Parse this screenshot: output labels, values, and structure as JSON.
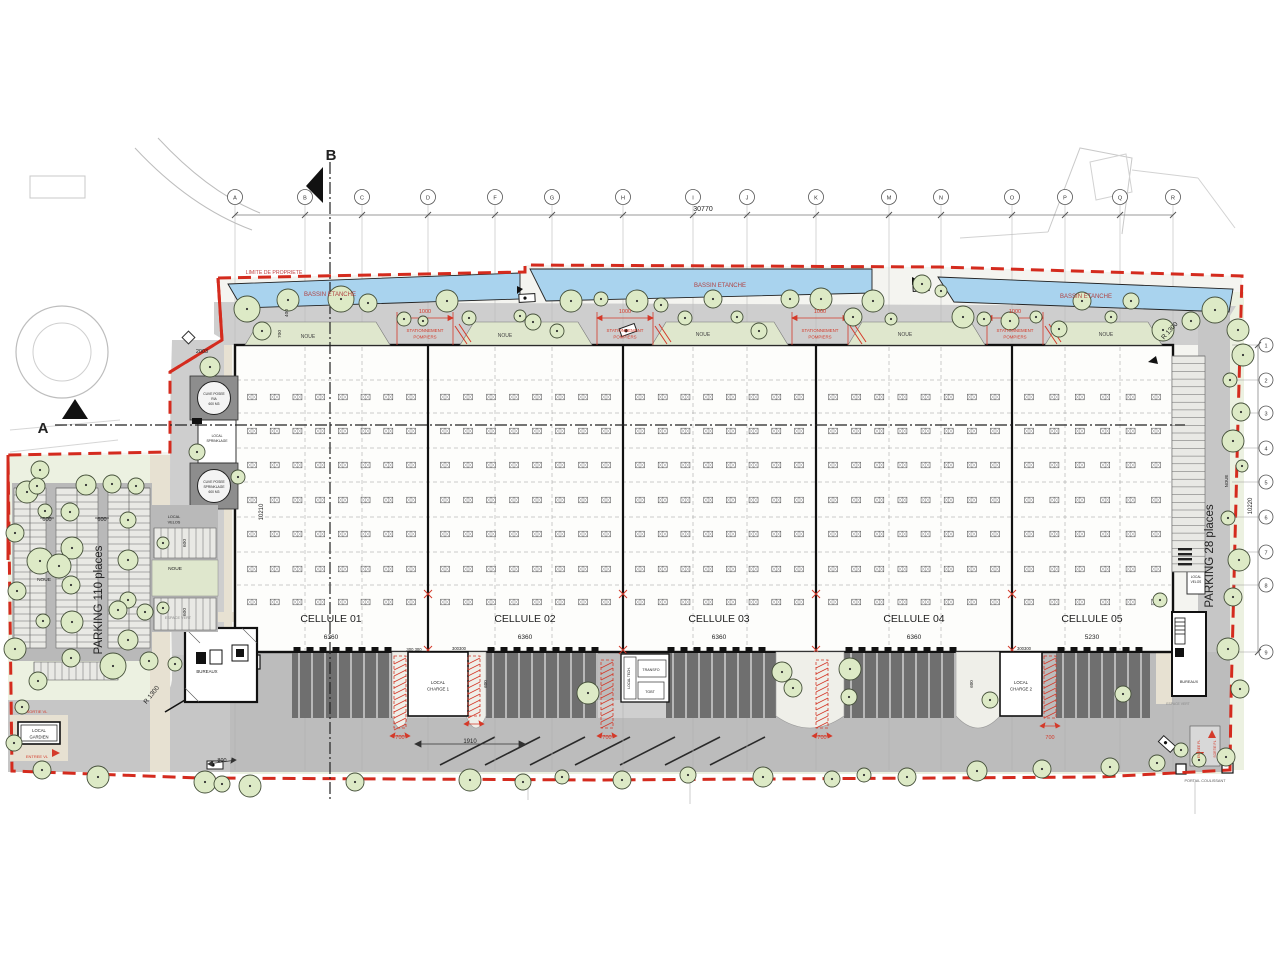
{
  "drawing": {
    "kind": "architectural site plan - logistics warehouse",
    "boundary_color": "#d42b1e",
    "water_color": "#a9d3ee",
    "tree_fill": "#ddeac6"
  },
  "grid": {
    "letters": [
      "A",
      "B",
      "C",
      "D",
      "F",
      "G",
      "H",
      "I",
      "J",
      "K",
      "M",
      "N",
      "O",
      "P",
      "Q",
      "R"
    ],
    "rows": [
      "1",
      "2",
      "3",
      "4",
      "5",
      "6",
      "7",
      "8",
      "9"
    ],
    "overall_dim": "30770",
    "right_dim": "10220"
  },
  "cellules": [
    {
      "label": "CELLULE 01",
      "dim": "6360"
    },
    {
      "label": "CELLULE 02",
      "dim": "6360"
    },
    {
      "label": "CELLULE 03",
      "dim": "6360"
    },
    {
      "label": "CELLULE 04",
      "dim": "6360"
    },
    {
      "label": "CELLULE 05",
      "dim": "5230"
    }
  ],
  "annotations": [
    {
      "name": "section-label-b",
      "text": "B",
      "x": 331,
      "y": 160,
      "size": 15,
      "bold": true
    },
    {
      "name": "section-label-a",
      "text": "A",
      "x": 43,
      "y": 433,
      "size": 15,
      "bold": true
    },
    {
      "name": "limite-propriete-label",
      "text": "LIMITE DE PROPRIETE",
      "x": 274,
      "y": 274,
      "size": 5.2,
      "color": "#c04040"
    },
    {
      "name": "bassin-etanche-label-1",
      "text": "BASSIN ETANCHE",
      "x": 330,
      "y": 296,
      "size": 6,
      "color": "#b04040"
    },
    {
      "name": "bassin-etanche-label-2",
      "text": "BASSIN ETANCHE",
      "x": 720,
      "y": 287,
      "size": 6,
      "color": "#b04040"
    },
    {
      "name": "bassin-etanche-label-3",
      "text": "BASSIN ETANCHE",
      "x": 1086,
      "y": 298,
      "size": 6,
      "color": "#b04040"
    },
    {
      "name": "overall-dim-label",
      "text": "30770",
      "x": 703,
      "y": 211,
      "size": 7,
      "color": "#222"
    },
    {
      "name": "noue-label-1",
      "text": "NOUE",
      "x": 308,
      "y": 338,
      "size": 5,
      "color": "#444"
    },
    {
      "name": "noue-label-2",
      "text": "NOUE",
      "x": 505,
      "y": 337,
      "size": 5,
      "color": "#444"
    },
    {
      "name": "noue-label-3",
      "text": "NOUE",
      "x": 703,
      "y": 336,
      "size": 5,
      "color": "#444"
    },
    {
      "name": "noue-label-4",
      "text": "NOUE",
      "x": 905,
      "y": 336,
      "size": 5,
      "color": "#444"
    },
    {
      "name": "noue-label-5",
      "text": "NOUE",
      "x": 1106,
      "y": 336,
      "size": 5,
      "color": "#444"
    },
    {
      "name": "pompiers-dim-1",
      "text": "1000",
      "x": 425,
      "y": 313,
      "size": 5.5,
      "color": "#d43a2a"
    },
    {
      "name": "pompiers-label-1a",
      "text": "STATIONNEMENT",
      "x": 425,
      "y": 332,
      "size": 4.4,
      "color": "#d43a2a"
    },
    {
      "name": "pompiers-label-1b",
      "text": "POMPIERS",
      "x": 425,
      "y": 338.5,
      "size": 4.4,
      "color": "#d43a2a"
    },
    {
      "name": "pompiers-dim-2",
      "text": "1000",
      "x": 625,
      "y": 313,
      "size": 5.5,
      "color": "#d43a2a"
    },
    {
      "name": "pompiers-label-2a",
      "text": "STATIONNEMENT",
      "x": 625,
      "y": 332,
      "size": 4.4,
      "color": "#d43a2a"
    },
    {
      "name": "pompiers-label-2b",
      "text": "POMPIERS",
      "x": 625,
      "y": 338.5,
      "size": 4.4,
      "color": "#d43a2a"
    },
    {
      "name": "pompiers-dim-3",
      "text": "1000",
      "x": 820,
      "y": 313,
      "size": 5.5,
      "color": "#d43a2a"
    },
    {
      "name": "pompiers-label-3a",
      "text": "STATIONNEMENT",
      "x": 820,
      "y": 332,
      "size": 4.4,
      "color": "#d43a2a"
    },
    {
      "name": "pompiers-label-3b",
      "text": "POMPIERS",
      "x": 820,
      "y": 338.5,
      "size": 4.4,
      "color": "#d43a2a"
    },
    {
      "name": "pompiers-dim-4",
      "text": "1000",
      "x": 1015,
      "y": 313,
      "size": 5.5,
      "color": "#d43a2a"
    },
    {
      "name": "pompiers-label-4a",
      "text": "STATIONNEMENT",
      "x": 1015,
      "y": 332,
      "size": 4.4,
      "color": "#d43a2a"
    },
    {
      "name": "pompiers-label-4b",
      "text": "POMPIERS",
      "x": 1015,
      "y": 338.5,
      "size": 4.4,
      "color": "#d43a2a"
    },
    {
      "name": "cellule-01-label",
      "text": "CELLULE 01",
      "x": 331,
      "y": 622,
      "size": 10.5
    },
    {
      "name": "cellule-01-dim",
      "text": "6360",
      "x": 331,
      "y": 639,
      "size": 6.5
    },
    {
      "name": "cellule-02-label",
      "text": "CELLULE 02",
      "x": 525,
      "y": 622,
      "size": 10.5
    },
    {
      "name": "cellule-02-dim",
      "text": "6360",
      "x": 525,
      "y": 639,
      "size": 6.5
    },
    {
      "name": "cellule-03-label",
      "text": "CELLULE 03",
      "x": 719,
      "y": 622,
      "size": 10.5
    },
    {
      "name": "cellule-03-dim",
      "text": "6360",
      "x": 719,
      "y": 639,
      "size": 6.5
    },
    {
      "name": "cellule-04-label",
      "text": "CELLULE 04",
      "x": 914,
      "y": 622,
      "size": 10.5
    },
    {
      "name": "cellule-04-dim",
      "text": "6360",
      "x": 914,
      "y": 639,
      "size": 6.5
    },
    {
      "name": "cellule-05-label",
      "text": "CELLULE 05",
      "x": 1092,
      "y": 622,
      "size": 10.5
    },
    {
      "name": "cellule-05-dim",
      "text": "5230",
      "x": 1092,
      "y": 639,
      "size": 6.5
    },
    {
      "name": "interior-dim-10210",
      "text": "10210",
      "x": 263,
      "y": 512,
      "size": 6,
      "rot": -90
    },
    {
      "name": "dim-400",
      "text": "400",
      "x": 288,
      "y": 313,
      "size": 4.8,
      "rot": -90
    },
    {
      "name": "dim-700-west",
      "text": "700",
      "x": 281,
      "y": 334,
      "size": 4.8,
      "rot": -90
    },
    {
      "name": "level-2003",
      "text": "2003",
      "x": 202,
      "y": 353,
      "size": 5.5
    },
    {
      "name": "parking-110-label",
      "text": "PARKING 110 places",
      "x": 102,
      "y": 600,
      "size": 11.5,
      "rot": -90
    },
    {
      "name": "stall-dim-600-a",
      "text": "600",
      "x": 47,
      "y": 521,
      "size": 5.5
    },
    {
      "name": "stall-dim-600-b",
      "text": "600",
      "x": 102,
      "y": 521,
      "size": 5.5
    },
    {
      "name": "noue-left-label",
      "text": "NOUE",
      "x": 44,
      "y": 581,
      "size": 4.8
    },
    {
      "name": "noue-island-label",
      "text": "NOUE",
      "x": 175,
      "y": 570,
      "size": 4.8
    },
    {
      "name": "stall-dim-600-c",
      "text": "600",
      "x": 186,
      "y": 543,
      "size": 4.8,
      "rot": -90
    },
    {
      "name": "stall-dim-600-d",
      "text": "600",
      "x": 186,
      "y": 612,
      "size": 4.8,
      "rot": -90
    },
    {
      "name": "local-velos-left-a",
      "text": "LOCAL",
      "x": 174,
      "y": 518,
      "size": 3.8
    },
    {
      "name": "local-velos-left-b",
      "text": "VELOS",
      "x": 174,
      "y": 523.5,
      "size": 3.8
    },
    {
      "name": "bureaux-left-label",
      "text": "BUREAUX",
      "x": 207,
      "y": 673,
      "size": 4.4
    },
    {
      "name": "espace-vert-left",
      "text": "ESPACE VERT",
      "x": 178,
      "y": 619,
      "size": 3.8,
      "color": "#888"
    },
    {
      "name": "local-gardien-a",
      "text": "LOCAL",
      "x": 39,
      "y": 732,
      "size": 4.2
    },
    {
      "name": "local-gardien-b",
      "text": "GARDIEN",
      "x": 39,
      "y": 738.5,
      "size": 4.2
    },
    {
      "name": "sortie-vl-label",
      "text": "SORTIE VL",
      "x": 37,
      "y": 713,
      "size": 4,
      "color": "#d43a2a"
    },
    {
      "name": "entree-vl-label",
      "text": "ENTREE VL",
      "x": 37,
      "y": 758,
      "size": 4,
      "color": "#d43a2a"
    },
    {
      "name": "r1300-left",
      "text": "R 1300",
      "x": 153,
      "y": 696,
      "size": 6.5,
      "rot": -52
    },
    {
      "name": "dim-800",
      "text": "800",
      "x": 222,
      "y": 762,
      "size": 5.5
    },
    {
      "name": "dim-300-a",
      "text": "300 300",
      "x": 414,
      "y": 651,
      "size": 4.2
    },
    {
      "name": "dim-300-b",
      "text": "300300",
      "x": 459,
      "y": 650,
      "size": 4.2
    },
    {
      "name": "dim-300-c",
      "text": "300300",
      "x": 1024,
      "y": 650,
      "size": 4.2
    },
    {
      "name": "dim-1910",
      "text": "1910",
      "x": 470,
      "y": 743,
      "size": 6
    },
    {
      "name": "dim-700-dock-1",
      "text": "700",
      "x": 400,
      "y": 739,
      "size": 5.5,
      "color": "#d43a2a"
    },
    {
      "name": "dim-700-dock-2",
      "text": "700",
      "x": 607,
      "y": 739,
      "size": 5.5,
      "color": "#d43a2a"
    },
    {
      "name": "dim-700-dock-3",
      "text": "700",
      "x": 822,
      "y": 739,
      "size": 5.5,
      "color": "#d43a2a"
    },
    {
      "name": "dim-700-dock-4",
      "text": "700",
      "x": 1050,
      "y": 739,
      "size": 5.5,
      "color": "#d43a2a"
    },
    {
      "name": "dim-600-dock-a",
      "text": "600",
      "x": 487,
      "y": 684,
      "size": 4.5,
      "rot": -90
    },
    {
      "name": "dim-600-dock-b",
      "text": "600",
      "x": 973,
      "y": 684,
      "size": 4.5,
      "rot": -90
    },
    {
      "name": "local-charge1-a",
      "text": "LOCAL",
      "x": 438,
      "y": 684,
      "size": 4.3
    },
    {
      "name": "local-charge1-b",
      "text": "CHARGE 1",
      "x": 438,
      "y": 690.5,
      "size": 4.3
    },
    {
      "name": "local-charge2-a",
      "text": "LOCAL",
      "x": 1021,
      "y": 684,
      "size": 4.3
    },
    {
      "name": "local-charge2-b",
      "text": "CHARGE 2",
      "x": 1021,
      "y": 690.5,
      "size": 4.3
    },
    {
      "name": "transfo-label",
      "text": "TRANSFO",
      "x": 651,
      "y": 671,
      "size": 3.6
    },
    {
      "name": "tgbt-label",
      "text": "TGBT",
      "x": 650,
      "y": 693,
      "size": 3.6
    },
    {
      "name": "local-tech-label",
      "text": "LOCAL TECH.",
      "x": 630,
      "y": 678,
      "size": 3.3,
      "rot": -90
    },
    {
      "name": "cuve1-a",
      "text": "CUVE POSEE",
      "x": 214,
      "y": 395,
      "size": 3.3
    },
    {
      "name": "cuve1-b",
      "text": "RIA",
      "x": 214,
      "y": 400,
      "size": 3.3
    },
    {
      "name": "cuve1-c",
      "text": "600 M3",
      "x": 214,
      "y": 405,
      "size": 3.3
    },
    {
      "name": "local-sprk-a",
      "text": "LOCAL",
      "x": 217,
      "y": 437,
      "size": 3.3
    },
    {
      "name": "local-sprk-b",
      "text": "SPRINKLAGE",
      "x": 217,
      "y": 442,
      "size": 3.3
    },
    {
      "name": "cuve2-a",
      "text": "CUVE POSEE",
      "x": 214,
      "y": 483,
      "size": 3.3
    },
    {
      "name": "cuve2-b",
      "text": "SPRINKLAGE",
      "x": 214,
      "y": 488,
      "size": 3.3
    },
    {
      "name": "cuve2-c",
      "text": "600 M3",
      "x": 214,
      "y": 493,
      "size": 3.3
    },
    {
      "name": "bureaux-right-label",
      "text": "BUREAUX",
      "x": 1189,
      "y": 683,
      "size": 3.8
    },
    {
      "name": "espace-vert-right",
      "text": "ESPACE VERT",
      "x": 1178,
      "y": 705,
      "size": 3.4,
      "color": "#888"
    },
    {
      "name": "local-velos-right-a",
      "text": "LOCAL",
      "x": 1196,
      "y": 578,
      "size": 3.2
    },
    {
      "name": "local-velos-right-b",
      "text": "VELOS",
      "x": 1196,
      "y": 583,
      "size": 3.2
    },
    {
      "name": "parking-28-label",
      "text": "PARKING 28 places",
      "x": 1213,
      "y": 556,
      "size": 11.5,
      "rot": -90
    },
    {
      "name": "noue-right-label",
      "text": "NOUE",
      "x": 1228,
      "y": 481,
      "size": 4.4,
      "rot": -90
    },
    {
      "name": "right-dim-10220",
      "text": "10220",
      "x": 1252,
      "y": 506,
      "size": 6,
      "rot": -90
    },
    {
      "name": "r1300-right",
      "text": "R 1300",
      "x": 1171,
      "y": 332,
      "size": 6.5,
      "rot": -48
    },
    {
      "name": "portail-coulissant-label",
      "text": "PORTAIL COULISSANT",
      "x": 1205,
      "y": 782,
      "size": 3.8,
      "color": "#555"
    },
    {
      "name": "entree-pl-label",
      "text": "ENTREE PL",
      "x": 1200,
      "y": 749,
      "size": 3.3,
      "rot": -90,
      "color": "#d43a2a"
    },
    {
      "name": "sortie-pl-label",
      "text": "SORTIE PL",
      "x": 1216,
      "y": 749,
      "size": 3.3,
      "rot": -90,
      "color": "#d43a2a"
    }
  ]
}
